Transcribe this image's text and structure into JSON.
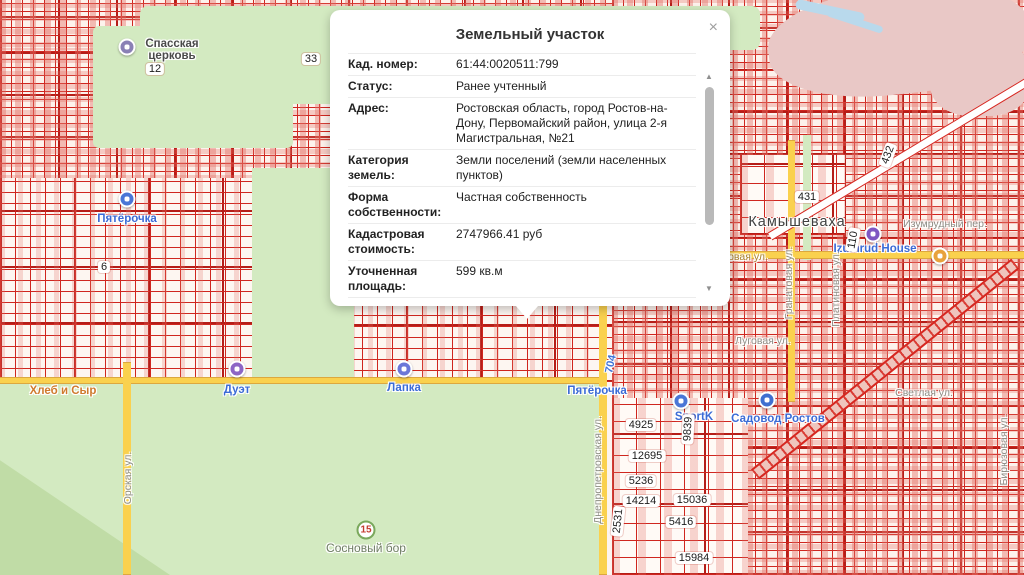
{
  "popup": {
    "title": "Земельный участок",
    "close_icon": "×",
    "scroll_up_icon": "▲",
    "scroll_down_icon": "▼",
    "fields": [
      {
        "label": "Кад. номер:",
        "value": "61:44:0020511:799"
      },
      {
        "label": "Статус:",
        "value": "Ранее учтенный"
      },
      {
        "label": "Адрес:",
        "value": "Ростовская область, город Ростов-на-Дону, Первомайский район, улица 2-я Магистральная, №21"
      },
      {
        "label": "Категория земель:",
        "value": "Земли поселений (земли населенных пунктов)"
      },
      {
        "label": "Форма собственности:",
        "value": "Частная собственность"
      },
      {
        "label": "Кадастровая стоимость:",
        "value": "2747966.41 руб"
      },
      {
        "label": "Уточненная площадь:",
        "value": "599 кв.м"
      }
    ]
  },
  "map": {
    "colors": {
      "parcel_red": "#d6261f",
      "park_green": "#d3eac1",
      "road_yellow": "#fad14e",
      "poi_blue": "#3b6bd6",
      "industrial_pink": "#e9c8c6"
    },
    "labels": [
      {
        "name": "poi-label-spasskaya-tserkov",
        "text": "Спасская церковь",
        "type": "poi-dark",
        "x": 172,
        "y": 50,
        "w": 66
      },
      {
        "name": "quarter-number-12",
        "text": "12",
        "type": "quarter",
        "x": 155,
        "y": 69
      },
      {
        "name": "quarter-number-33",
        "text": "33",
        "type": "quarter",
        "x": 311,
        "y": 59
      },
      {
        "name": "poi-label-pyaterochka",
        "text": "Пятёрочка",
        "type": "poi",
        "x": 127,
        "y": 219
      },
      {
        "name": "quarter-number-6",
        "text": "6",
        "type": "quarter",
        "x": 104,
        "y": 267
      },
      {
        "name": "poi-label-hleb-i-syr",
        "text": "Хлеб и Сыр",
        "type": "poi-orange",
        "x": 63,
        "y": 391
      },
      {
        "name": "poi-label-duet",
        "text": "Дуэт",
        "type": "poi",
        "x": 237,
        "y": 390
      },
      {
        "name": "poi-label-lapka",
        "text": "Лапка",
        "type": "poi",
        "x": 404,
        "y": 388
      },
      {
        "name": "poi-label-pyaterochka-2",
        "text": "Пятёрочка",
        "type": "poi",
        "x": 597,
        "y": 391
      },
      {
        "name": "road-number-704",
        "text": "704",
        "type": "roadnum",
        "x": 611,
        "y": 364,
        "rot": -78
      },
      {
        "name": "locality-label-kamyshevakha",
        "text": "Камышеваха",
        "type": "locality",
        "x": 797,
        "y": 222
      },
      {
        "name": "quarter-number-431",
        "text": "431",
        "type": "quarter",
        "x": 807,
        "y": 197
      },
      {
        "name": "quarter-number-432",
        "text": "432",
        "type": "quarter",
        "x": 888,
        "y": 155,
        "rot": -70
      },
      {
        "name": "street-label-izumrudny",
        "text": "Изумрудный пер.",
        "type": "street",
        "x": 945,
        "y": 224
      },
      {
        "name": "poi-label-izumrud-house",
        "text": "Izumrud House",
        "type": "poi",
        "x": 875,
        "y": 249
      },
      {
        "name": "quarter-number-110",
        "text": "110",
        "type": "quarter",
        "x": 853,
        "y": 240,
        "rot": -80
      },
      {
        "name": "street-label-ovaya",
        "text": "овая ул.",
        "type": "street-road",
        "x": 748,
        "y": 257
      },
      {
        "name": "street-label-granatovaya",
        "text": "Гранатовая ул.",
        "type": "street",
        "x": 789,
        "y": 283,
        "rot": -90
      },
      {
        "name": "street-label-platinovaya",
        "text": "Платиновая ул.",
        "type": "street",
        "x": 836,
        "y": 289,
        "rot": -90
      },
      {
        "name": "street-label-lugovaya",
        "text": "Луговая ул.",
        "type": "street",
        "x": 763,
        "y": 341
      },
      {
        "name": "street-label-svetlaya",
        "text": "Светлая ул.",
        "type": "street",
        "x": 924,
        "y": 393
      },
      {
        "name": "poi-label-sportk",
        "text": "SportK",
        "type": "poi",
        "x": 694,
        "y": 417
      },
      {
        "name": "poi-label-sadovod-rostov",
        "text": "Садовод Ростов",
        "type": "poi",
        "x": 778,
        "y": 419
      },
      {
        "name": "quarter-number-4925",
        "text": "4925",
        "type": "quarter",
        "x": 641,
        "y": 425
      },
      {
        "name": "quarter-number-9839",
        "text": "9839",
        "type": "quarter",
        "x": 688,
        "y": 429,
        "rot": -87
      },
      {
        "name": "quarter-number-12695",
        "text": "12695",
        "type": "quarter",
        "x": 647,
        "y": 456
      },
      {
        "name": "quarter-number-5236",
        "text": "5236",
        "type": "quarter",
        "x": 641,
        "y": 481
      },
      {
        "name": "quarter-number-14214",
        "text": "14214",
        "type": "quarter",
        "x": 641,
        "y": 501
      },
      {
        "name": "quarter-number-15036",
        "text": "15036",
        "type": "quarter",
        "x": 692,
        "y": 500
      },
      {
        "name": "quarter-number-2531",
        "text": "2531",
        "type": "quarter",
        "x": 618,
        "y": 521,
        "rot": -84
      },
      {
        "name": "quarter-number-5416",
        "text": "5416",
        "type": "quarter",
        "x": 681,
        "y": 522
      },
      {
        "name": "quarter-number-15984",
        "text": "15984",
        "type": "quarter",
        "x": 694,
        "y": 558
      },
      {
        "name": "park-label-sosnovy-bor",
        "text": "Сосновый бор",
        "type": "park",
        "x": 366,
        "y": 548
      },
      {
        "name": "park-number-15",
        "text": "15",
        "type": "parknum",
        "x": 366,
        "y": 530
      },
      {
        "name": "street-label-orskaya",
        "text": "Орская ул.",
        "type": "street",
        "x": 128,
        "y": 478,
        "rot": -90
      },
      {
        "name": "street-label-dnepropetrovskaya",
        "text": "Днепропетровская ул.",
        "type": "street",
        "x": 598,
        "y": 470,
        "rot": -90
      },
      {
        "name": "street-label-biryuzovaya",
        "text": "Бирюзовая ул.",
        "type": "street",
        "x": 1004,
        "y": 450,
        "rot": -90
      }
    ],
    "markers": [
      {
        "name": "church-icon",
        "x": 127,
        "y": 47,
        "color": "#8a80b5"
      },
      {
        "name": "pyaterochka-icon",
        "x": 127,
        "y": 199,
        "color": "#4a76d6"
      },
      {
        "name": "duet-icon",
        "x": 237,
        "y": 369,
        "color": "#8d65c5"
      },
      {
        "name": "lapka-icon",
        "x": 404,
        "y": 369,
        "color": "#6b77d8"
      },
      {
        "name": "izumrud-house-icon",
        "x": 873,
        "y": 234,
        "color": "#7e57c2"
      },
      {
        "name": "sportk-icon",
        "x": 681,
        "y": 401,
        "color": "#4a76d6"
      },
      {
        "name": "sadovod-icon",
        "x": 767,
        "y": 400,
        "color": "#3f6fd0"
      },
      {
        "name": "transit-stop-icon",
        "x": 940,
        "y": 256,
        "color": "#e8a23c"
      }
    ]
  }
}
